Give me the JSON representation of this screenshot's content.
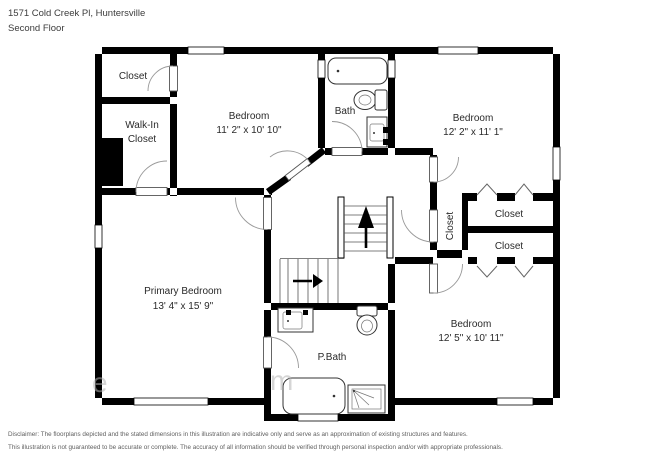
{
  "header": {
    "address": "1571 Cold Creek Pl, Huntersville",
    "floor_label": "Second Floor"
  },
  "rooms": {
    "closet_top_left": {
      "label": "Closet"
    },
    "walk_in_closet": {
      "line1": "Walk-In",
      "line2": "Closet"
    },
    "bedroom_top": {
      "label": "Bedroom",
      "dimensions": "11' 2\" x 10' 10\""
    },
    "bath": {
      "label": "Bath"
    },
    "bedroom_right": {
      "label": "Bedroom",
      "dimensions": "12' 2\" x 11' 1\""
    },
    "closet_vertical": {
      "label": "Closet"
    },
    "closet_right_upper": {
      "label": "Closet"
    },
    "closet_right_lower": {
      "label": "Closet"
    },
    "primary_bedroom": {
      "label": "Primary Bedroom",
      "dimensions": "13' 4\" x 15' 9\""
    },
    "primary_bath": {
      "label": "P.Bath"
    },
    "bedroom_bottom_right": {
      "label": "Bedroom",
      "dimensions": "12' 5\" x 10' 11\""
    }
  },
  "watermark": {
    "fragments": [
      "e",
      "m"
    ]
  },
  "disclaimer": {
    "line1": "Disclaimer: The floorplans depicted and the stated dimensions in this illustration are indicative only and serve as an approximation of existing structures and features.",
    "line2": "This illustration is not guaranteed to be accurate or complete. The accuracy of all information should be verified through personal inspection and/or with appropriate professionals."
  },
  "colors": {
    "wall": "#000000",
    "background": "#ffffff",
    "label_text": "#2a2a2a",
    "door_arc": "#999999"
  }
}
